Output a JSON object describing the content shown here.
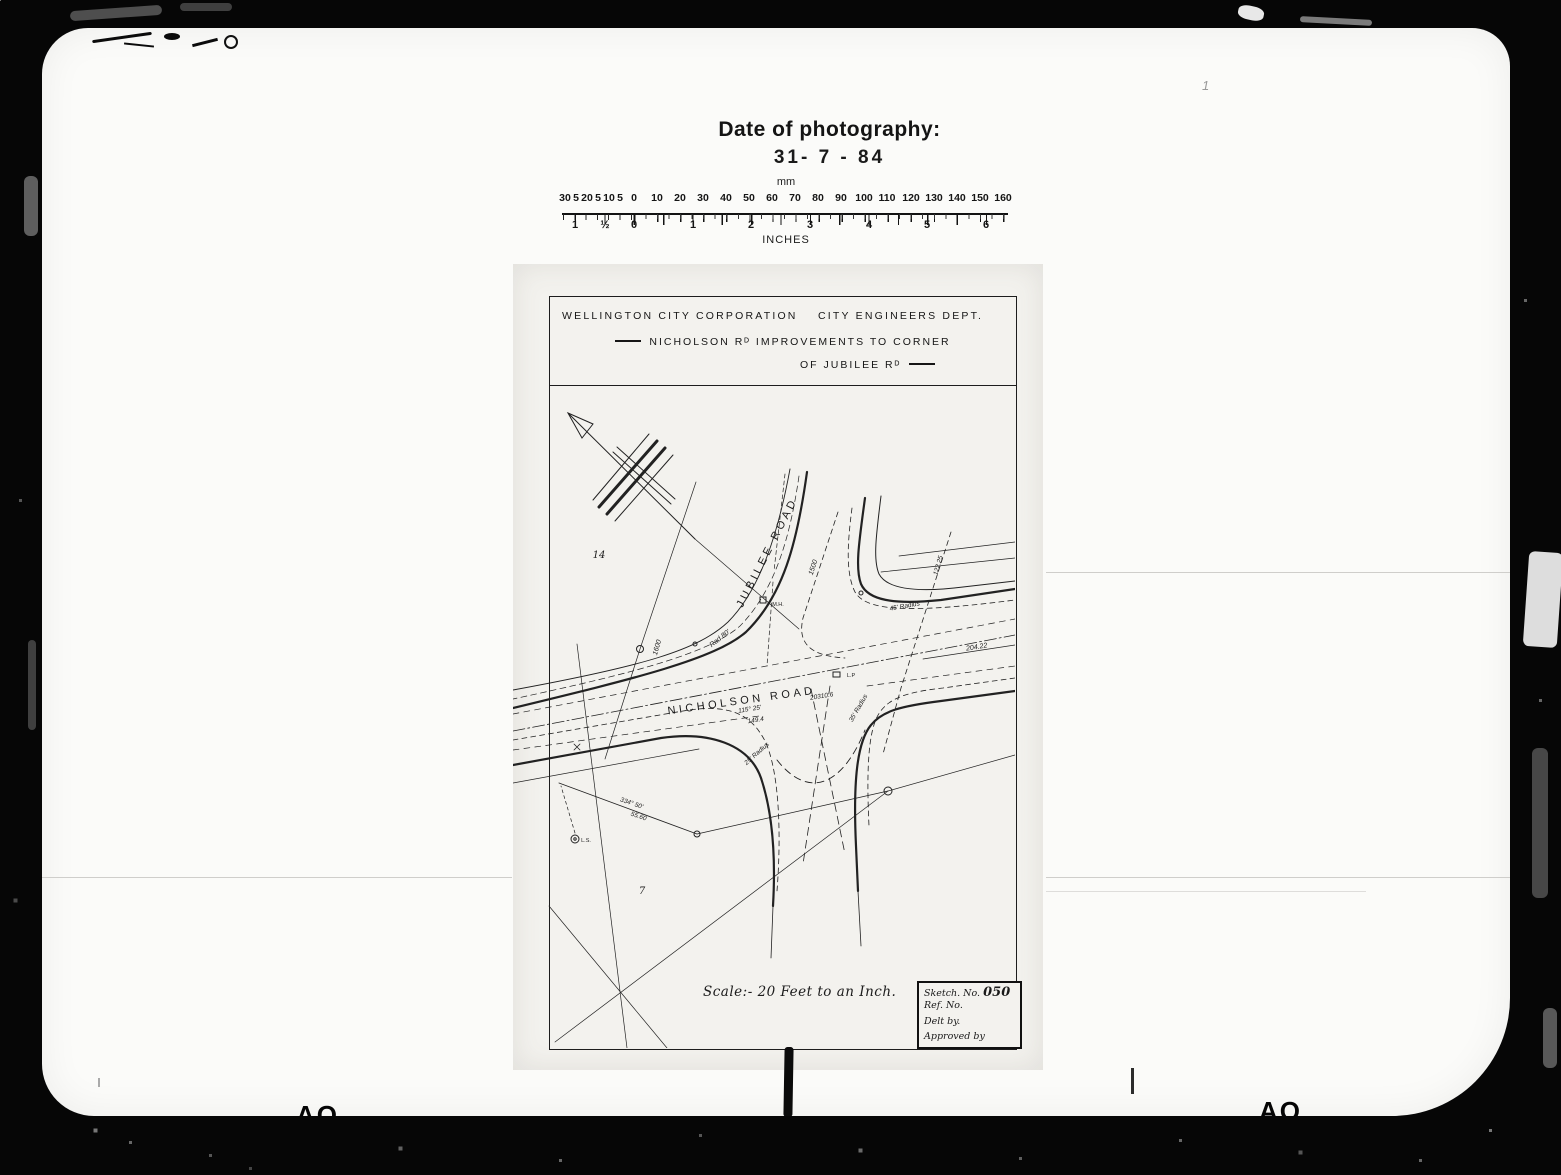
{
  "photo": {
    "date_label": "Date of photography:",
    "date_value": "31- 7 - 84"
  },
  "ruler": {
    "mm_label": "mm",
    "inches_label": "INCHES",
    "mm_ticks": [
      "30",
      "5",
      "20",
      "5",
      "10",
      "5",
      "0",
      "10",
      "20",
      "30",
      "40",
      "50",
      "60",
      "70",
      "80",
      "90",
      "100",
      "110",
      "120",
      "130",
      "140",
      "150",
      "160"
    ],
    "inch_ticks": [
      "1",
      "½",
      "0",
      "1",
      "2",
      "3",
      "4",
      "5",
      "6"
    ]
  },
  "plan": {
    "title": {
      "org": "WELLINGTON CITY CORPORATION",
      "dept": "CITY ENGINEERS DEPT.",
      "line1": "NICHOLSON Rᴰ  IMPROVEMENTS TO CORNER",
      "line2": "OF JUBILEE Rᴰ"
    },
    "map_labels": {
      "jubilee_road": "JUBILEE  ROAD",
      "nicholson_road": "NICHOLSON  ROAD",
      "parcel_14": "14",
      "parcel_7": "7",
      "rad_80": "Rad 80'",
      "dim_1600": "1600",
      "dim_1500": "1500",
      "manhole": "M.H.",
      "lamp_post": "L.P",
      "survey_mark": "L.S.",
      "bearing_115": "115° 25'",
      "dist_149": "149.4",
      "peg_20310": "20310.6",
      "dim_204": "204.22",
      "dim_122": "122.25",
      "radius_45": "45' Radius",
      "radius_35": "35' Radius",
      "radius_25": "25' Radius",
      "bearing_334": "334° 50'",
      "dist_55": "55.60"
    },
    "scale_note": "Scale:- 20 Feet to an Inch.",
    "sketch_box": {
      "sketch_no_label": "Sketch. No.",
      "sketch_no_value": "050",
      "ref_no_label": "Ref. No.",
      "delt_by_label": "Delt by.",
      "approved_by_label": "Approved by"
    }
  },
  "film": {
    "bottom_marks": [
      "AO",
      "AO",
      "AO"
    ],
    "tick_mark": "1"
  }
}
